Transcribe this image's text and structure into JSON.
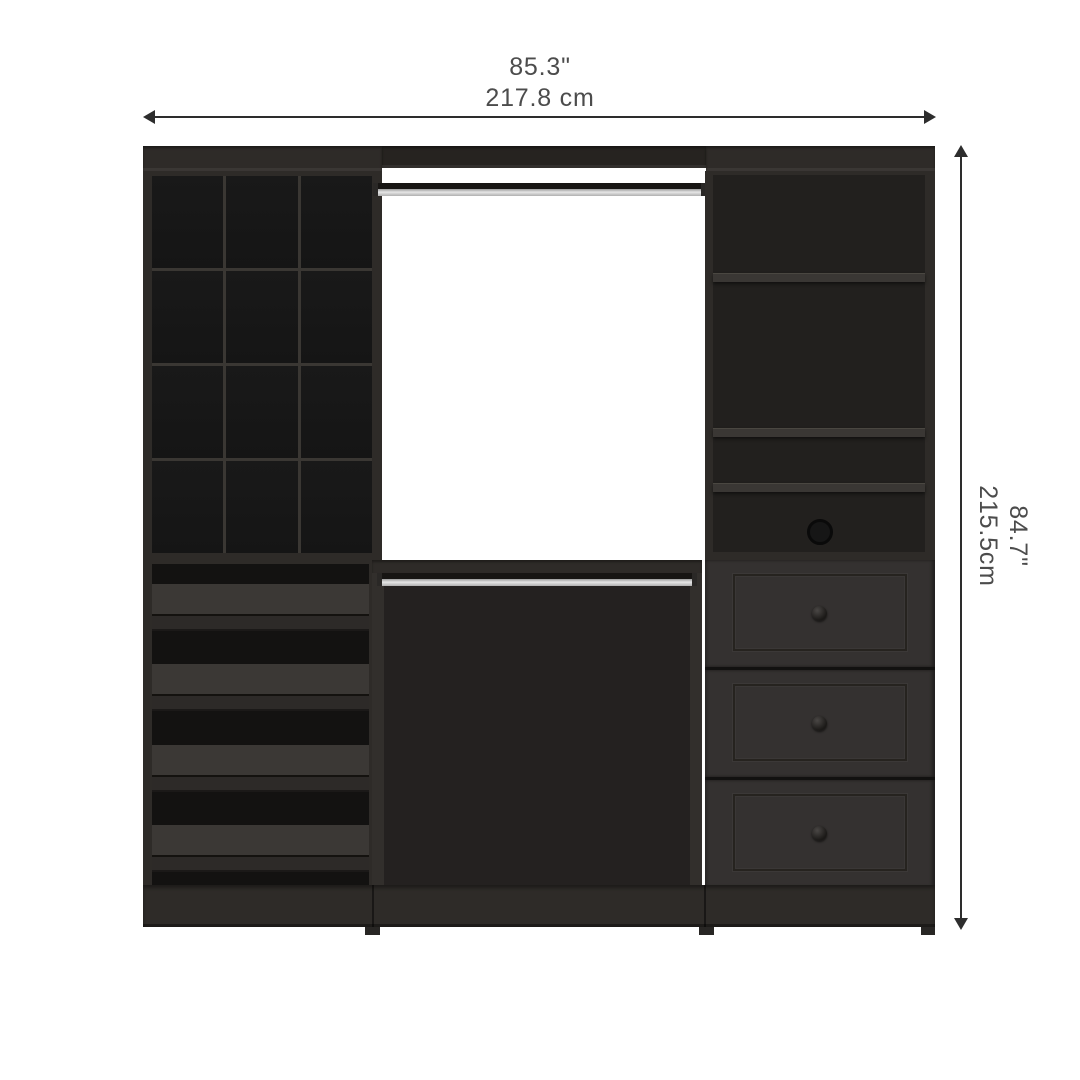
{
  "annotations": {
    "width": {
      "inches": "85.3\"",
      "cm": "217.8 cm"
    },
    "height": {
      "inches": "84.7\"",
      "cm": "215.5cm"
    }
  },
  "structure": {
    "left_tower": {
      "cubby_rows": 4,
      "cubby_cols": 3,
      "shoe_shelves": 4
    },
    "middle_section": {
      "hanging_rods": 2
    },
    "right_tower": {
      "open_shelves": 4,
      "drawers": 3
    }
  },
  "colors": {
    "background": "#ffffff",
    "dimension_text": "#4c4c4c",
    "dimension_line": "#2d2d2d",
    "wood_frame": "#2e2b28",
    "wood_dark_band": "#262320",
    "interior_dark": "#242120",
    "drawer_front": "#343130",
    "rod_silver": "#9a9a9a",
    "shelf_surface": "#3b3835"
  }
}
